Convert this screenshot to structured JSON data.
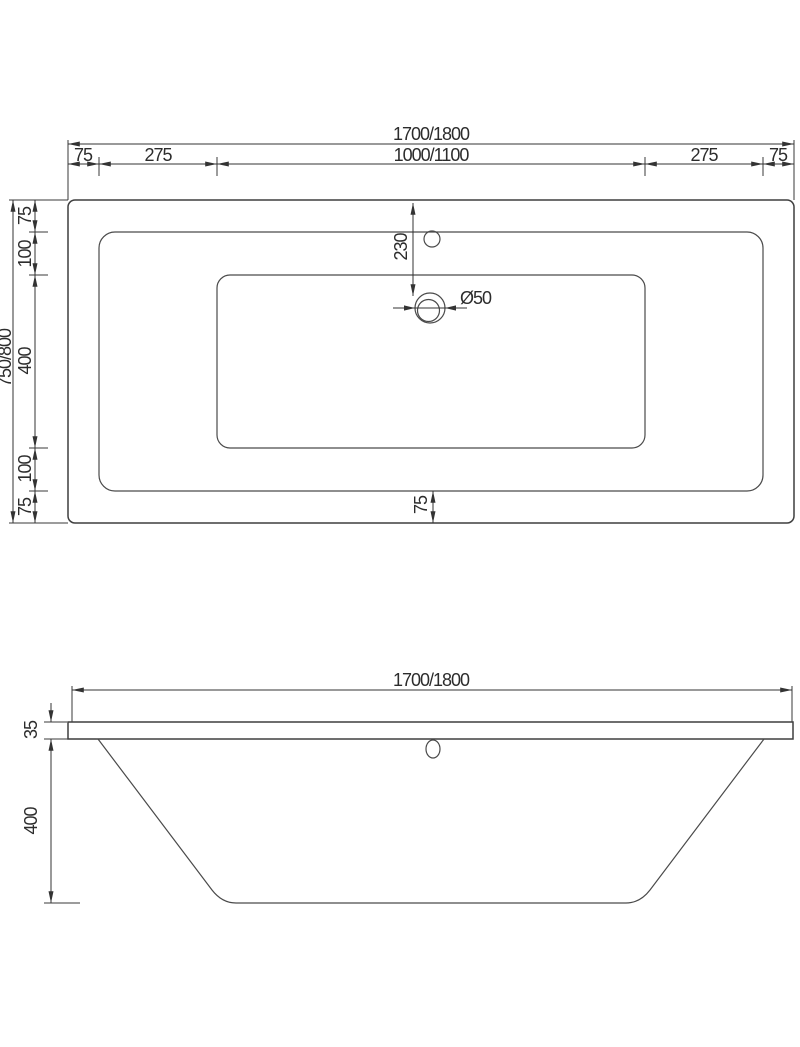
{
  "plan_view": {
    "overall_width": "1700/1800",
    "width_segments": [
      "75",
      "275",
      "1000/1100",
      "275",
      "75"
    ],
    "overall_depth": "750/800",
    "depth_segments": [
      "75",
      "100",
      "400",
      "100",
      "75"
    ],
    "drain_offset": "230",
    "drain_diameter": "Ø50",
    "bottom_rim_width": "75"
  },
  "front_view": {
    "overall_width": "1700/1800",
    "rim_thickness": "35",
    "body_depth": "400"
  },
  "style": {
    "line_color": "#3f3f3f",
    "dim_color": "#333333",
    "background": "#ffffff"
  }
}
